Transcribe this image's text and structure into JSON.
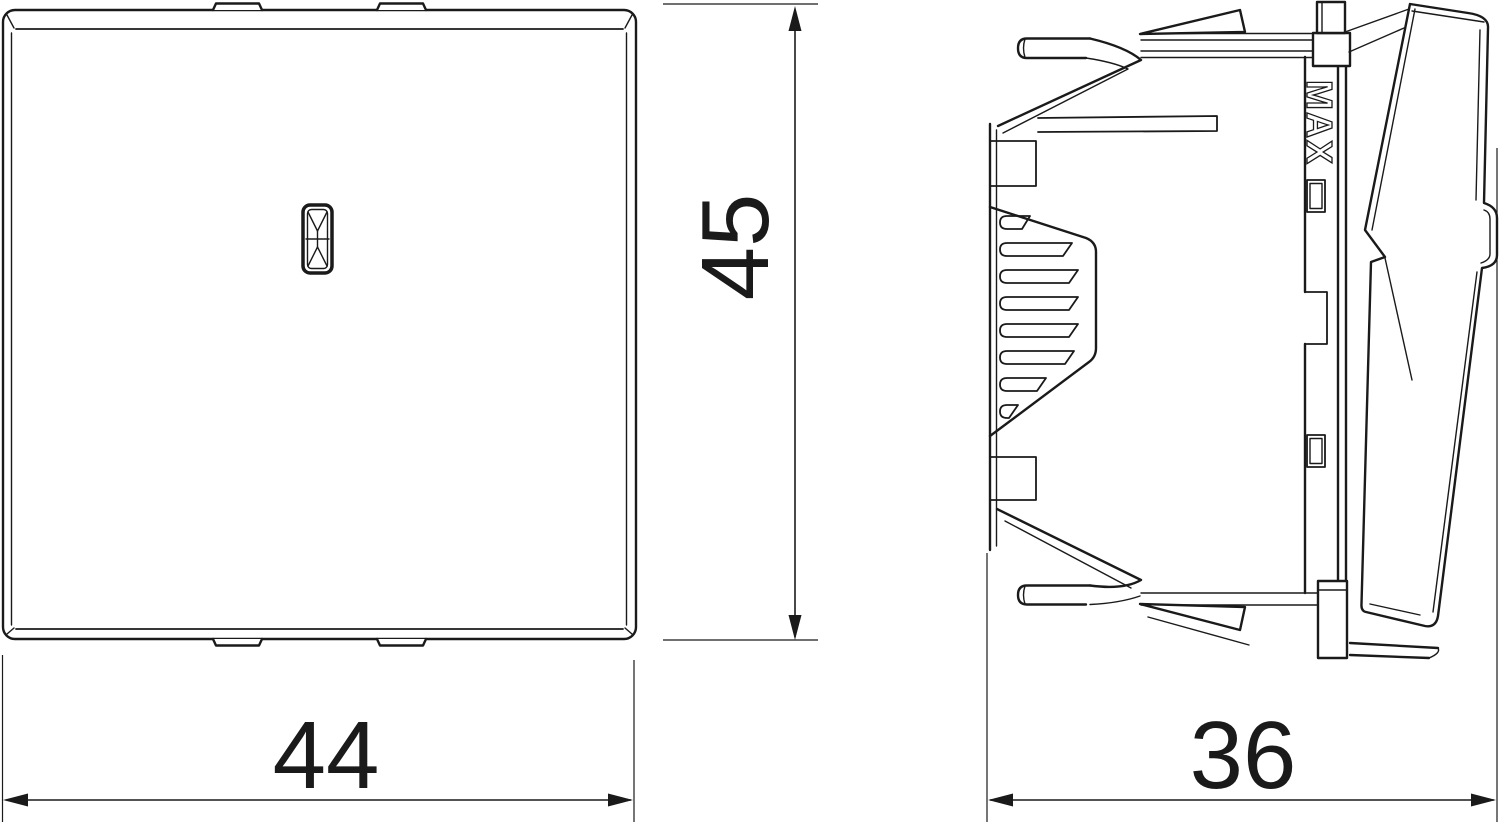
{
  "drawing": {
    "background_color": "#ffffff",
    "line_color": "#1a1a1a",
    "dimensions": {
      "width": "44",
      "height": "45",
      "depth": "36"
    },
    "side_marking": "MAX"
  }
}
